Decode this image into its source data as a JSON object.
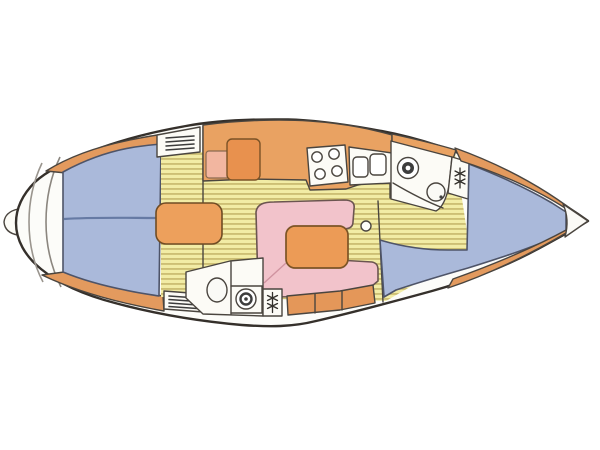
{
  "diagram": {
    "subject": "sailboat interior floor plan (top-down deck layout drawing)",
    "bow_direction": "right",
    "stern_direction": "left",
    "features": [
      "transom-steps",
      "rudder",
      "aft-double-berth",
      "companionway-step-box",
      "nav-seat",
      "icebox",
      "galley-counter",
      "stove-4-burners",
      "double-sink",
      "u-shaped-settee",
      "saloon-table",
      "cup-holder",
      "stowage-lockers",
      "aft-head-toilet",
      "aft-head-sink",
      "aft-hanging-locker",
      "forward-head-toilet",
      "forward-head-sink",
      "forward-hanging-locker",
      "v-berth",
      "bow-shelves",
      "anchor-locker",
      "cabin-sole-planks",
      "vent-grill-aft-top",
      "vent-grill-aft-bottom"
    ],
    "burner_count": "4"
  },
  "colors": {
    "background": "#ffffff",
    "hull_fill": "#fcfcf9",
    "hull_line": "#35302b",
    "floor_base": "#f2eca5",
    "floor_stripe": "#c9ba6f",
    "berth_blue": "#aab9da",
    "berth_edge": "#4e5468",
    "berth_seam": "#5b6e9a",
    "counter_orange": "#e9a262",
    "wedge_orange": "#e39a5e",
    "fridge_orange": "#e8914e",
    "block_orange": "#eda05c",
    "table_orange": "#ec9b56",
    "locker_orange": "#e49759",
    "settee_pink": "#f2c3cb",
    "pink_seam": "#d093a0",
    "seat_salmon": "#f2b6a0",
    "fixture_white": "#fcfbf6",
    "tip_white": "#fbfaf6",
    "steps_gray": "#9a958e"
  }
}
